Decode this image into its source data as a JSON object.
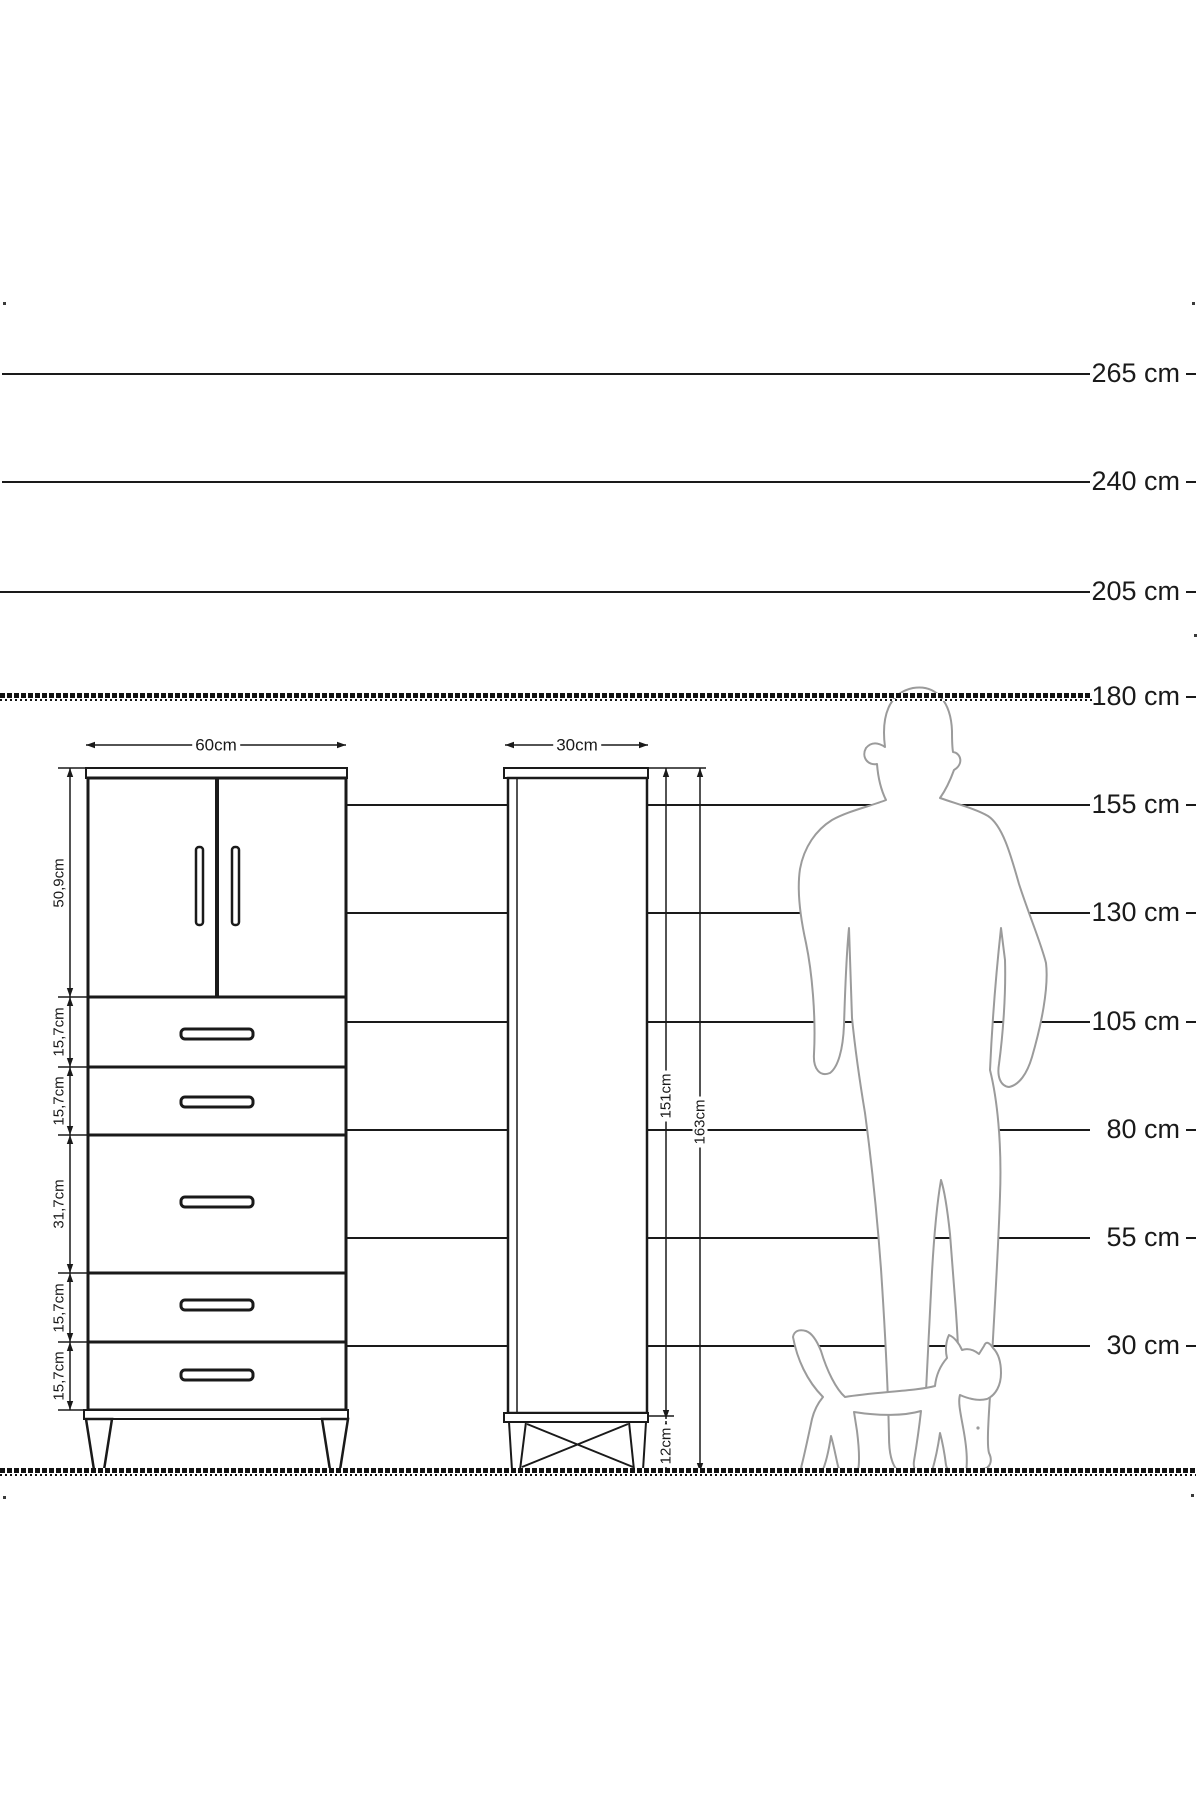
{
  "title": "furniture-dimension-diagram",
  "scale": {
    "items": [
      "265 cm",
      "240 cm",
      "205 cm",
      "180 cm",
      "155 cm",
      "130 cm",
      "105 cm",
      "80 cm",
      "55 cm",
      "30 cm"
    ],
    "ceiling_line_label": "180 cm",
    "unit": "cm"
  },
  "cabinet_front": {
    "width_label": "60cm",
    "section_labels": [
      "50,9cm",
      "15,7cm",
      "15,7cm",
      "31,7cm",
      "15,7cm",
      "15,7cm"
    ],
    "doors": 2,
    "drawers": 5
  },
  "cabinet_side": {
    "width_label": "30cm",
    "body_height_label": "151cm",
    "total_height_label": "163cm",
    "leg_height_label": "12cm"
  },
  "figures": {
    "person": "person-silhouette",
    "cat": "cat-silhouette"
  },
  "colors": {
    "ink": "#1a1a1a",
    "silhouette": "#9b9b9b",
    "background": "#ffffff"
  }
}
